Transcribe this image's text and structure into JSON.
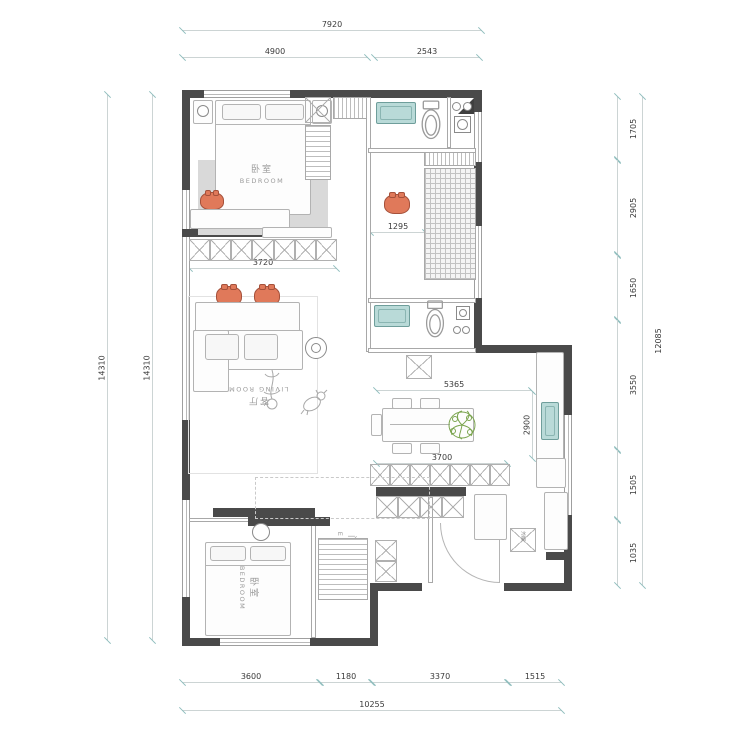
{
  "title": "apartment-floor-plan",
  "dims": {
    "top_overall": "7920",
    "top_seg1": "4900",
    "top_seg2": "2543",
    "bottom_seg1": "3600",
    "bottom_seg2": "1180",
    "bottom_seg3": "3370",
    "bottom_seg4": "1515",
    "bottom_overall": "10255",
    "left_outer": "14310",
    "left_inner": "14310",
    "right_seg1": "1705",
    "right_seg2": "2905",
    "right_seg3": "1650",
    "right_seg4": "3550",
    "right_seg5": "1505",
    "right_seg6": "1035",
    "right_overall": "12085",
    "wardrobe_width": "3720",
    "study_width": "1295",
    "dining_width": "5365",
    "kitchen_width": "3700",
    "counter_depth": "2900"
  },
  "rooms": {
    "bedroom1": {
      "zh": "卧室",
      "en": "BEDROOM"
    },
    "bedroom2": {
      "zh": "卧室",
      "en": "BEDROOM"
    },
    "living": {
      "zh": "客厅",
      "en": "LIVING ROOM"
    },
    "entry": {
      "zh": "门厅",
      "en": "ENTRY"
    },
    "fridge": {
      "zh": "冰箱"
    }
  },
  "colors": {
    "wall": "#4a4a4a",
    "accent_orange": "#e0795a",
    "fixture_teal": "#b9dad8",
    "plant_green": "#7aa44e",
    "dim_line": "#ccd4d4",
    "dim_tick": "#8fbdbd",
    "label_gray": "#9b9b9b"
  }
}
